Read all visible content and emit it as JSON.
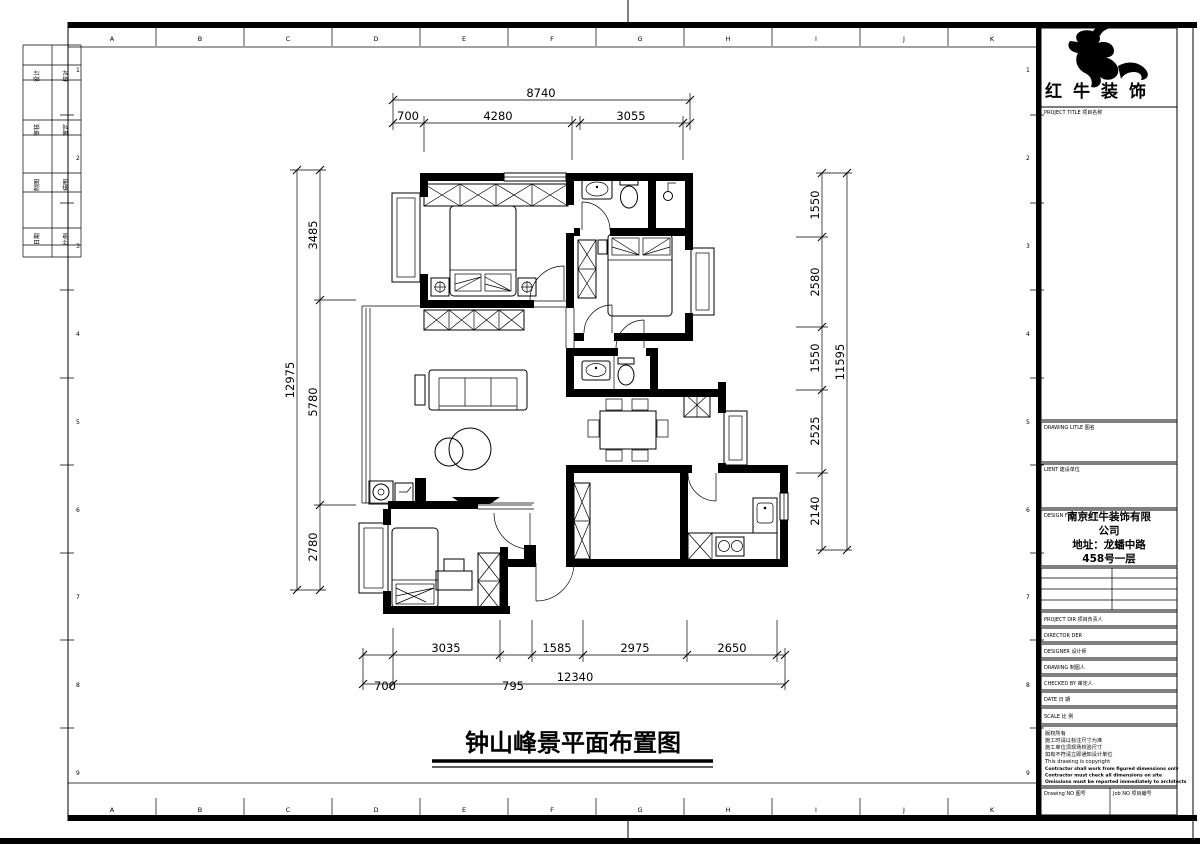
{
  "sheet": {
    "grid_letters": [
      "A",
      "B",
      "C",
      "D",
      "E",
      "F",
      "G",
      "H",
      "I",
      "J",
      "K"
    ],
    "row_numbers_left": [
      "1",
      "2",
      "3",
      "4",
      "5",
      "6",
      "7",
      "8",
      "9"
    ],
    "row_numbers_right": [
      "1",
      "2",
      "3",
      "4",
      "5",
      "6",
      "7",
      "8",
      "9"
    ],
    "signoff_labels": [
      "设计",
      "校对",
      "审核",
      "审定",
      "制图",
      "描图",
      "日期",
      "比例"
    ]
  },
  "logo": {
    "brand": "红牛装饰"
  },
  "title_block": {
    "project_title_label": "PROJECT TITLE  项目名称",
    "drawing_title_label": "DRAWING LITLE  图名",
    "client_label": "LIENT  建设单位",
    "design_firm_label": "DESIGN FIRM  设计单位",
    "firm_line1": "南京红牛装饰有限",
    "firm_line2": "公司",
    "firm_line3": "地址：龙蟠中路",
    "firm_line4": "458号一层",
    "project_dir_label": "PROJECT DIR  项目负责人",
    "director_label": "DIRECTOR DER",
    "designer_label": "DESIGNER  设计师",
    "drawing_label": "DRAWING  制图人",
    "checked_label": "CHECKED BY  审定人",
    "date_label": "DATE  日 期",
    "scale_label": "SCALE  比 例",
    "copyright": [
      "版权所有",
      "施工时请以标注尺寸为准",
      "施工单位须现场校验尺寸",
      "如有不符请立即通知设计单位",
      "This drawing is copyright",
      "Contractor shall work from figured dimensions only",
      "Contractor must check all dimensions on site",
      "Omissions must be reported immediately to architects"
    ],
    "drawing_no_label": "Drawing NO  图号",
    "job_no_label": "Job NO 项目编号"
  },
  "plan": {
    "title": "钟山峰景平面布置图",
    "dims": {
      "top_total": "8740",
      "top": [
        "700",
        "4280",
        "3055"
      ],
      "left_total": "12975",
      "left": [
        "3485",
        "5780",
        "2780"
      ],
      "right_total": "11595",
      "right": [
        "1550",
        "2580",
        "1550",
        "2525",
        "2140"
      ],
      "bottom": [
        "3035",
        "1585",
        "2975",
        "2650"
      ],
      "bottom_left": "700",
      "bottom_mid": "795",
      "bottom_total": "12340"
    }
  }
}
